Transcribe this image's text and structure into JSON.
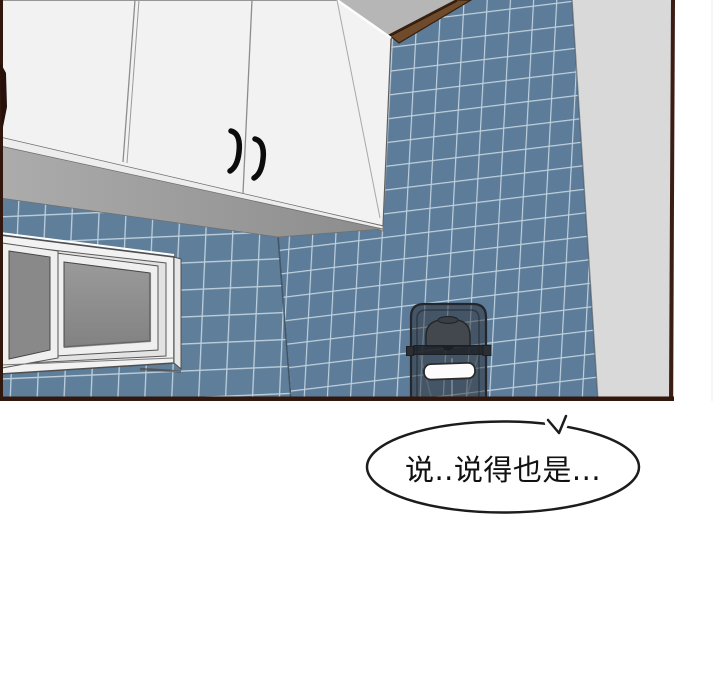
{
  "panel": {
    "type": "comic-panel",
    "objects": [
      "white upper kitchen cabinet with two black door handles",
      "blue mosaic tiled walls (two walls meeting at a corner)",
      "white sliding window with gray glass panes",
      "wood trim strip along top of right tile wall",
      "gray side wall at right",
      "semi-transparent dark pedal trash bin with white label"
    ]
  },
  "bubble": {
    "text": "说..说得也是..."
  },
  "colors": {
    "tile_blue": "#5f7e9a",
    "tile_grout": "#bdcfdd",
    "cabinet_white": "#f2f2f2",
    "soffit_gray": "#9c9c9c",
    "ceiling_gray": "#b6b6b6",
    "side_wall_gray": "#d9d9d9",
    "window_glass_gray": "#8f8f8f",
    "wood_trim_brown": "#6f4b2b",
    "panel_border_brown": "#31170d",
    "trash_bin_dark": "#2a2e34",
    "bubble_fill": "#ffffff",
    "bubble_stroke": "#1c1c1c"
  }
}
